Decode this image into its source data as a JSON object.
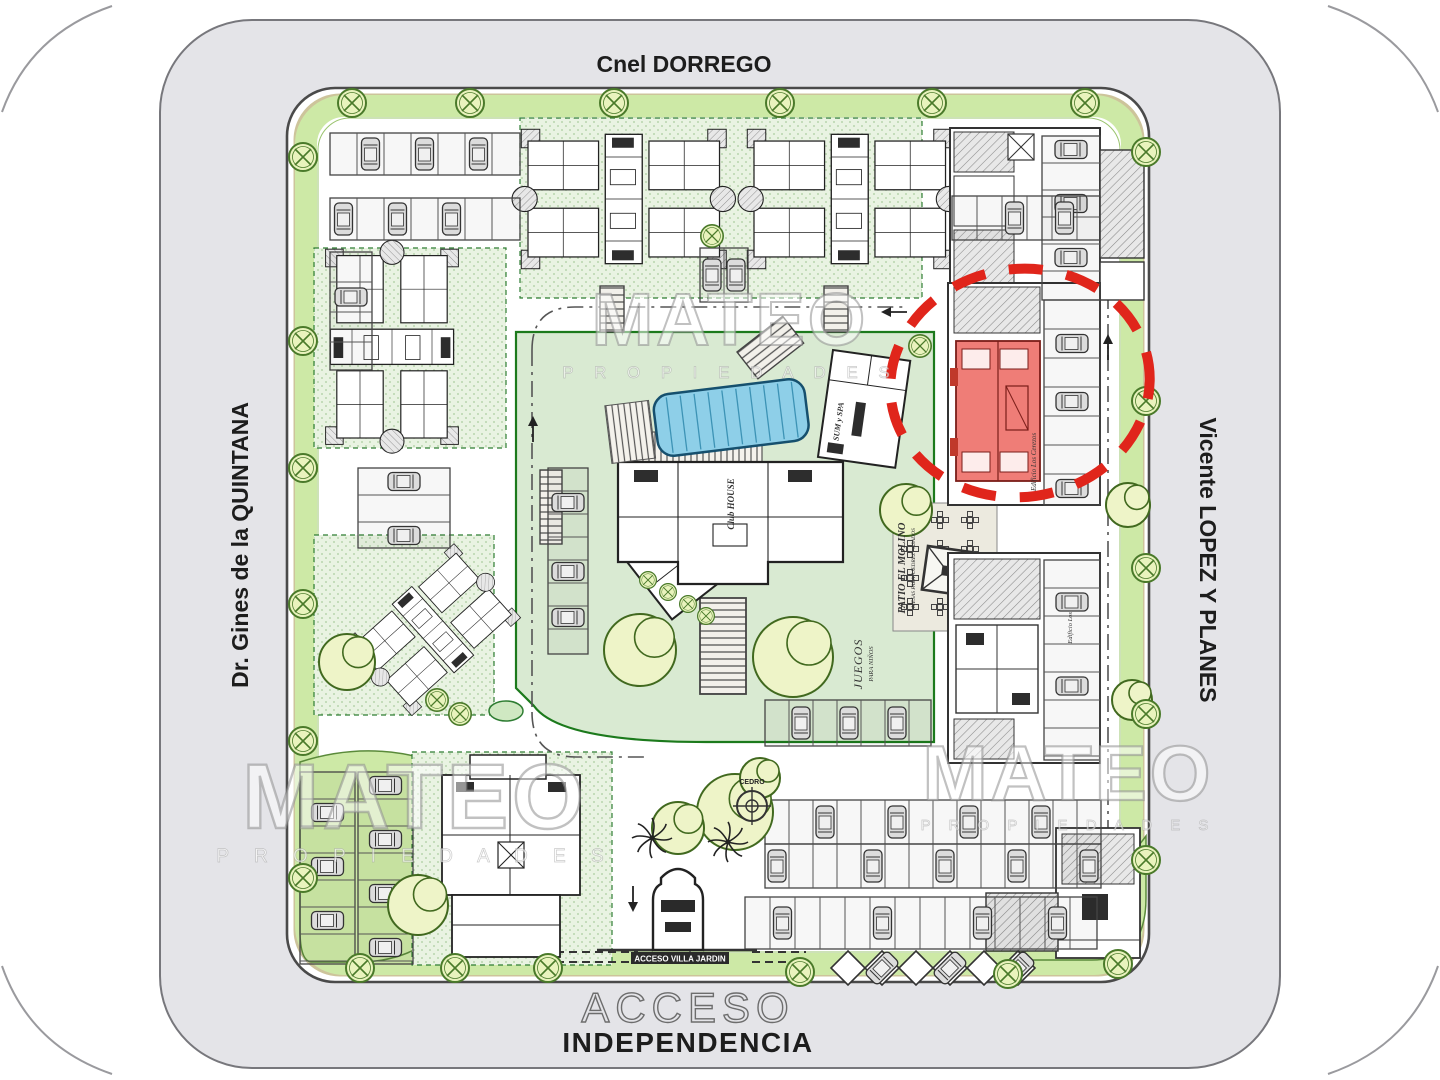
{
  "streets": {
    "top": "Cnel DORREGO",
    "left": "Dr. Gines de la QUINTANA",
    "right": "Vicente LOPEZ Y PLANES",
    "access_line1": "ACCESO",
    "access_line2": "INDEPENDENCIA"
  },
  "site": {
    "gate_band": "ACCESO VILLA JARDIN",
    "patio_title": "PATIO EL MOLINO",
    "patio_subtitle": "MESAS PARA AJEDREZ - ASADOS",
    "playground_line1": "JUEGOS",
    "playground_line2": "PARA NIÑOS",
    "clubhouse": "Club HOUSE",
    "sum_spa": "SUM y SPA",
    "cedro": "CEDRO",
    "building_highlight": "Edificio Los Cerezos",
    "building_right": "Edificio Los Ceibos"
  },
  "watermark": {
    "brand": "MATEO",
    "subtitle": "P R O P I E D A D E S"
  },
  "highlight": {
    "circle_color": "#e0251b",
    "unit_fill": "#ef7d77"
  },
  "palette": {
    "street": "#e4e4e8",
    "green_strip": "#cde9a6",
    "lawn": "#d9ead2",
    "pool": "#8ecfe8",
    "tree": "#eef4c8"
  }
}
